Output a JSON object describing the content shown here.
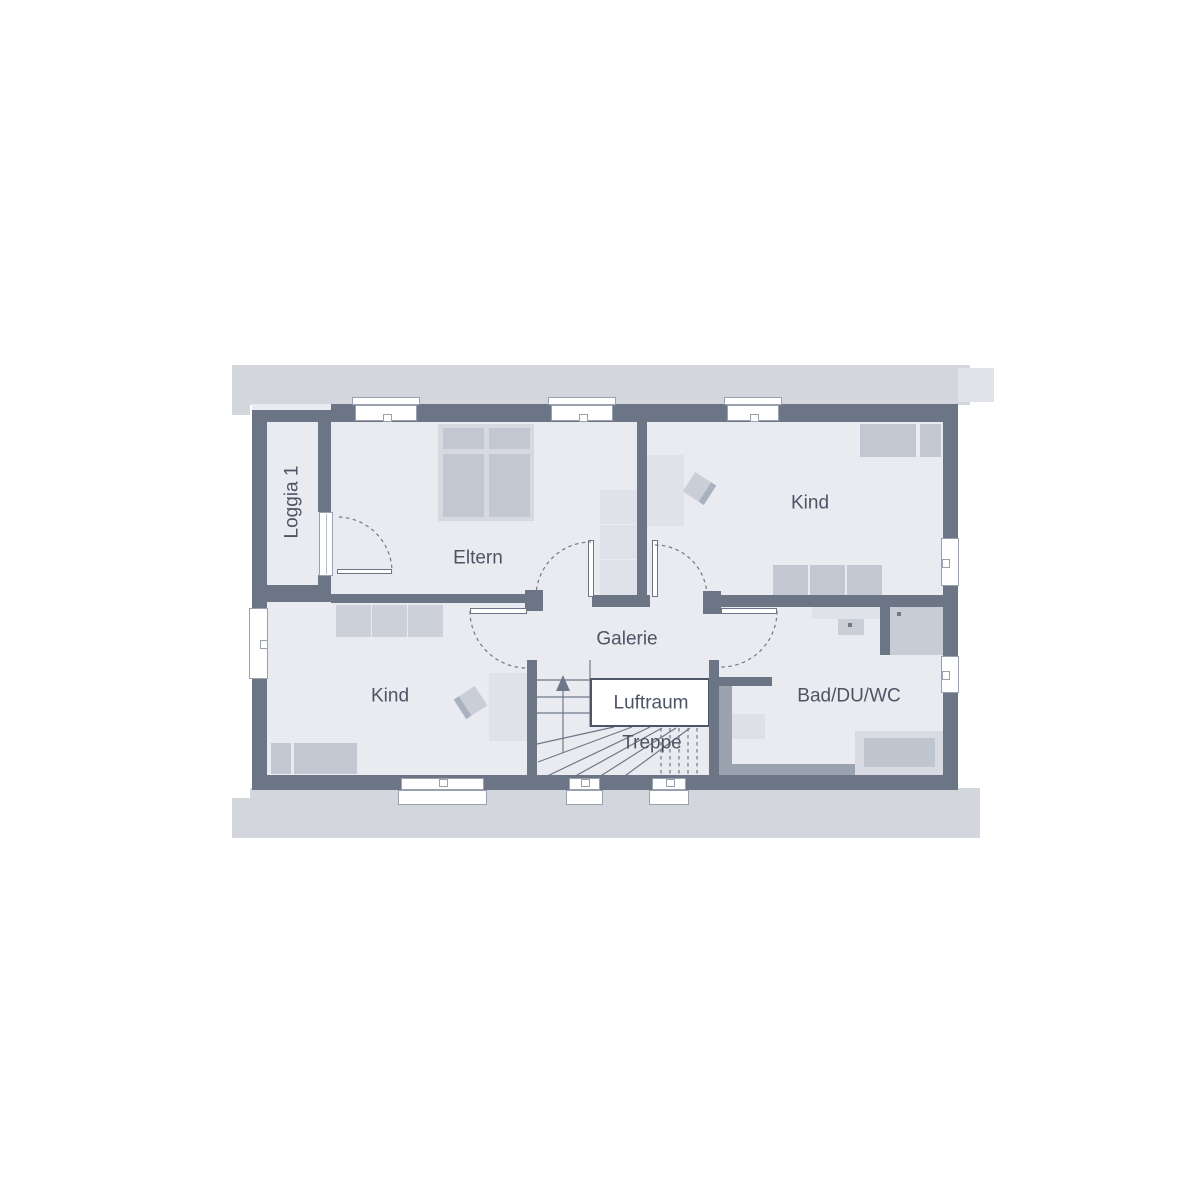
{
  "rooms": {
    "loggia": {
      "label": "Loggia 1"
    },
    "eltern": {
      "label": "Eltern"
    },
    "kind_top": {
      "label": "Kind"
    },
    "kind_bottom": {
      "label": "Kind"
    },
    "galerie": {
      "label": "Galerie"
    },
    "luftraum": {
      "label": "Luftraum"
    },
    "treppe": {
      "label": "Treppe"
    },
    "bad": {
      "label": "Bad/DU/WC"
    }
  },
  "colors": {
    "background": "#ffffff",
    "roof_band": "#d3d6dd",
    "roof_band_light": "#e0e3e9",
    "wall": "#6b7585",
    "floor": "#e9ebf0",
    "furniture_medium": "#c2c7d1",
    "furniture_light": "#dfe2e8",
    "furniture_mid": "#ccd1d9",
    "chair": "#c9ced7",
    "bad_band": "#9aa2b0",
    "line": "#6f7888",
    "window_border": "#99a1ae",
    "luftraum_border": "#4e5665",
    "text": "#4d5464"
  }
}
